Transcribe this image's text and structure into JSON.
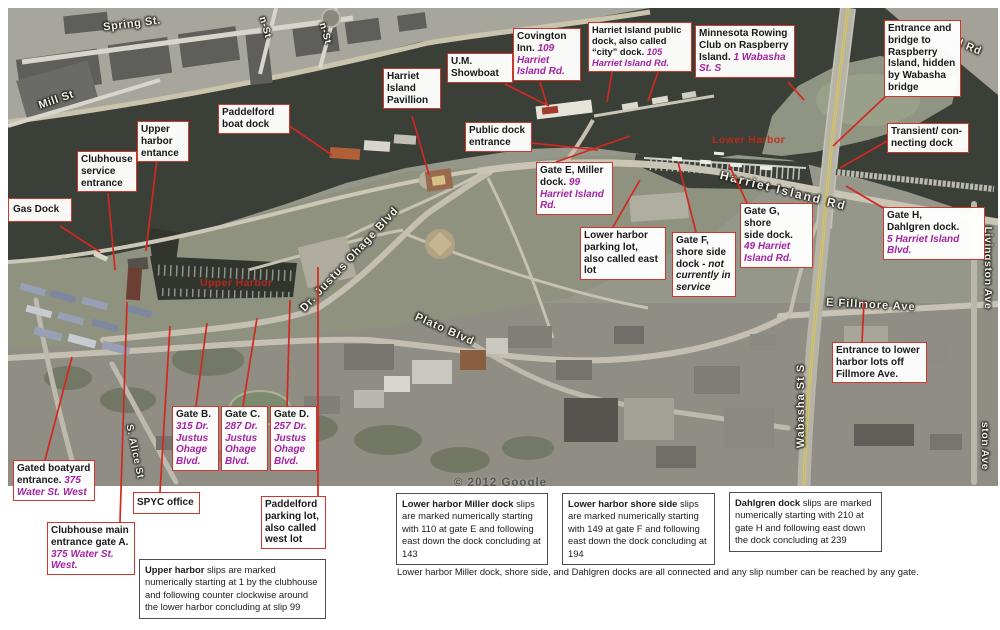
{
  "map": {
    "streets": {
      "spring_st": "Spring St.",
      "mill_st": "Mill St",
      "cross_st_a": "n-St",
      "cross_st_b": "n-St",
      "d_rd": "d Rd",
      "dr_justus_ohage": "Dr. Justus Ohage Blvd",
      "plato": "Plato Blvd",
      "harriet_island_rd": "Harriet Island Rd",
      "e_fillmore": "E Fillmore Ave",
      "wabasha": "Wabasha St S",
      "livingston": "Livingston Ave",
      "livingston_partial": "ston Ave",
      "s_alice": "S. Alice St"
    },
    "areas": {
      "upper_harbor": "Upper Harbor",
      "lower_harbor": "Lower Harbor"
    },
    "copyright": "© 2012 Google"
  },
  "callouts": {
    "gas_dock": {
      "label": "Gas Dock"
    },
    "clubhouse_service": {
      "label": "Clubhouse\nservice\nentrance"
    },
    "upper_harbor_entrance": {
      "label": "Upper\nharbor\nentance"
    },
    "paddelford_boat_dock": {
      "label": "Paddelford\nboat dock"
    },
    "harriet_island_pavillion": {
      "label": "Harriet\nIsland\nPavillion"
    },
    "um_showboat": {
      "label": "U.M.\nShowboat"
    },
    "public_dock_entrance": {
      "label": "Public dock\nentrance"
    },
    "covington_inn": {
      "label": "Covington\nInn. ",
      "addr": "109\nHarriet\nIsland Rd."
    },
    "city_dock": {
      "label": "Harriet Island public\ndock, also called\n“city” dock. ",
      "addr": "105\nHarriet Island Rd."
    },
    "rowing_club": {
      "label": "Minnesota Rowing\nClub on Raspberry\nIsland. ",
      "addr": "1 Wabasha\nSt. S"
    },
    "raspberry_entrance": {
      "label": "Entrance and\nbridge to\nRaspberry\nIsland, hidden\nby Wabasha\nbridge"
    },
    "transient_dock": {
      "label": "Transient/ con-\nnecting dock"
    },
    "gate_e": {
      "label": "Gate E, Miller\ndock. ",
      "addr": "99\nHarriet Island\nRd."
    },
    "lower_parking": {
      "label": "Lower harbor\nparking lot,\nalso called east\nlot"
    },
    "gate_f": {
      "label": "Gate F,\nshore side\ndock - ",
      "note": "not\ncurrently in\nservice"
    },
    "gate_g": {
      "label": "Gate G, shore\nside dock.\n",
      "addr": "49 Harriet\nIsland Rd."
    },
    "gate_h": {
      "label": "Gate H,\nDahlgren dock.\n",
      "addr": "5 Harriet Island\nBlvd."
    },
    "fillmore_entrance": {
      "label": "Entrance to lower\nharbor lots off\nFillmore Ave."
    },
    "gate_b": {
      "label": "Gate B.\n",
      "addr": "315 Dr.\nJustus\nOhage\nBlvd."
    },
    "gate_c": {
      "label": "Gate C.\n",
      "addr": "287 Dr.\nJustus\nOhage\nBlvd."
    },
    "gate_d": {
      "label": "Gate D.\n",
      "addr": "257 Dr.\nJustus\nOhage\nBlvd."
    },
    "gated_boatyard": {
      "label": "Gated boatyard\nentrance. ",
      "addr": "375\nWater St. West"
    },
    "clubhouse_main": {
      "label": "Clubhouse main\nentrance gate A.\n",
      "addr": "375 Water St.\nWest."
    },
    "spyc_office": {
      "label": "SPYC office"
    },
    "paddelford_parking": {
      "label": "Paddelford\nparking lot,\nalso called\nwest lot"
    }
  },
  "notes": {
    "upper_harbor": {
      "lead": "Upper harbor",
      "body": " slips are marked numerically starting at 1 by the clubhouse and following counter clockwise around the lower harbor concluding at slip 99"
    },
    "miller": {
      "lead": "Lower harbor Miller dock",
      "body": " slips are marked numerically starting with 110 at gate E and following east down the dock concluding at 143"
    },
    "shore_side": {
      "lead": "Lower harbor shore side",
      "body": " slips are marked numerically starting with 149 at gate F and following east down the dock concluding at 194"
    },
    "dahlgren": {
      "lead": "Dahlgren dock",
      "body": " slips are marked numerically starting with 210 at gate H and following east down the dock concluding at 239"
    }
  },
  "footnote": "Lower harbor Miller dock, shore side, and Dahlgren docks are all connected and any slip number can be reached by any gate."
}
